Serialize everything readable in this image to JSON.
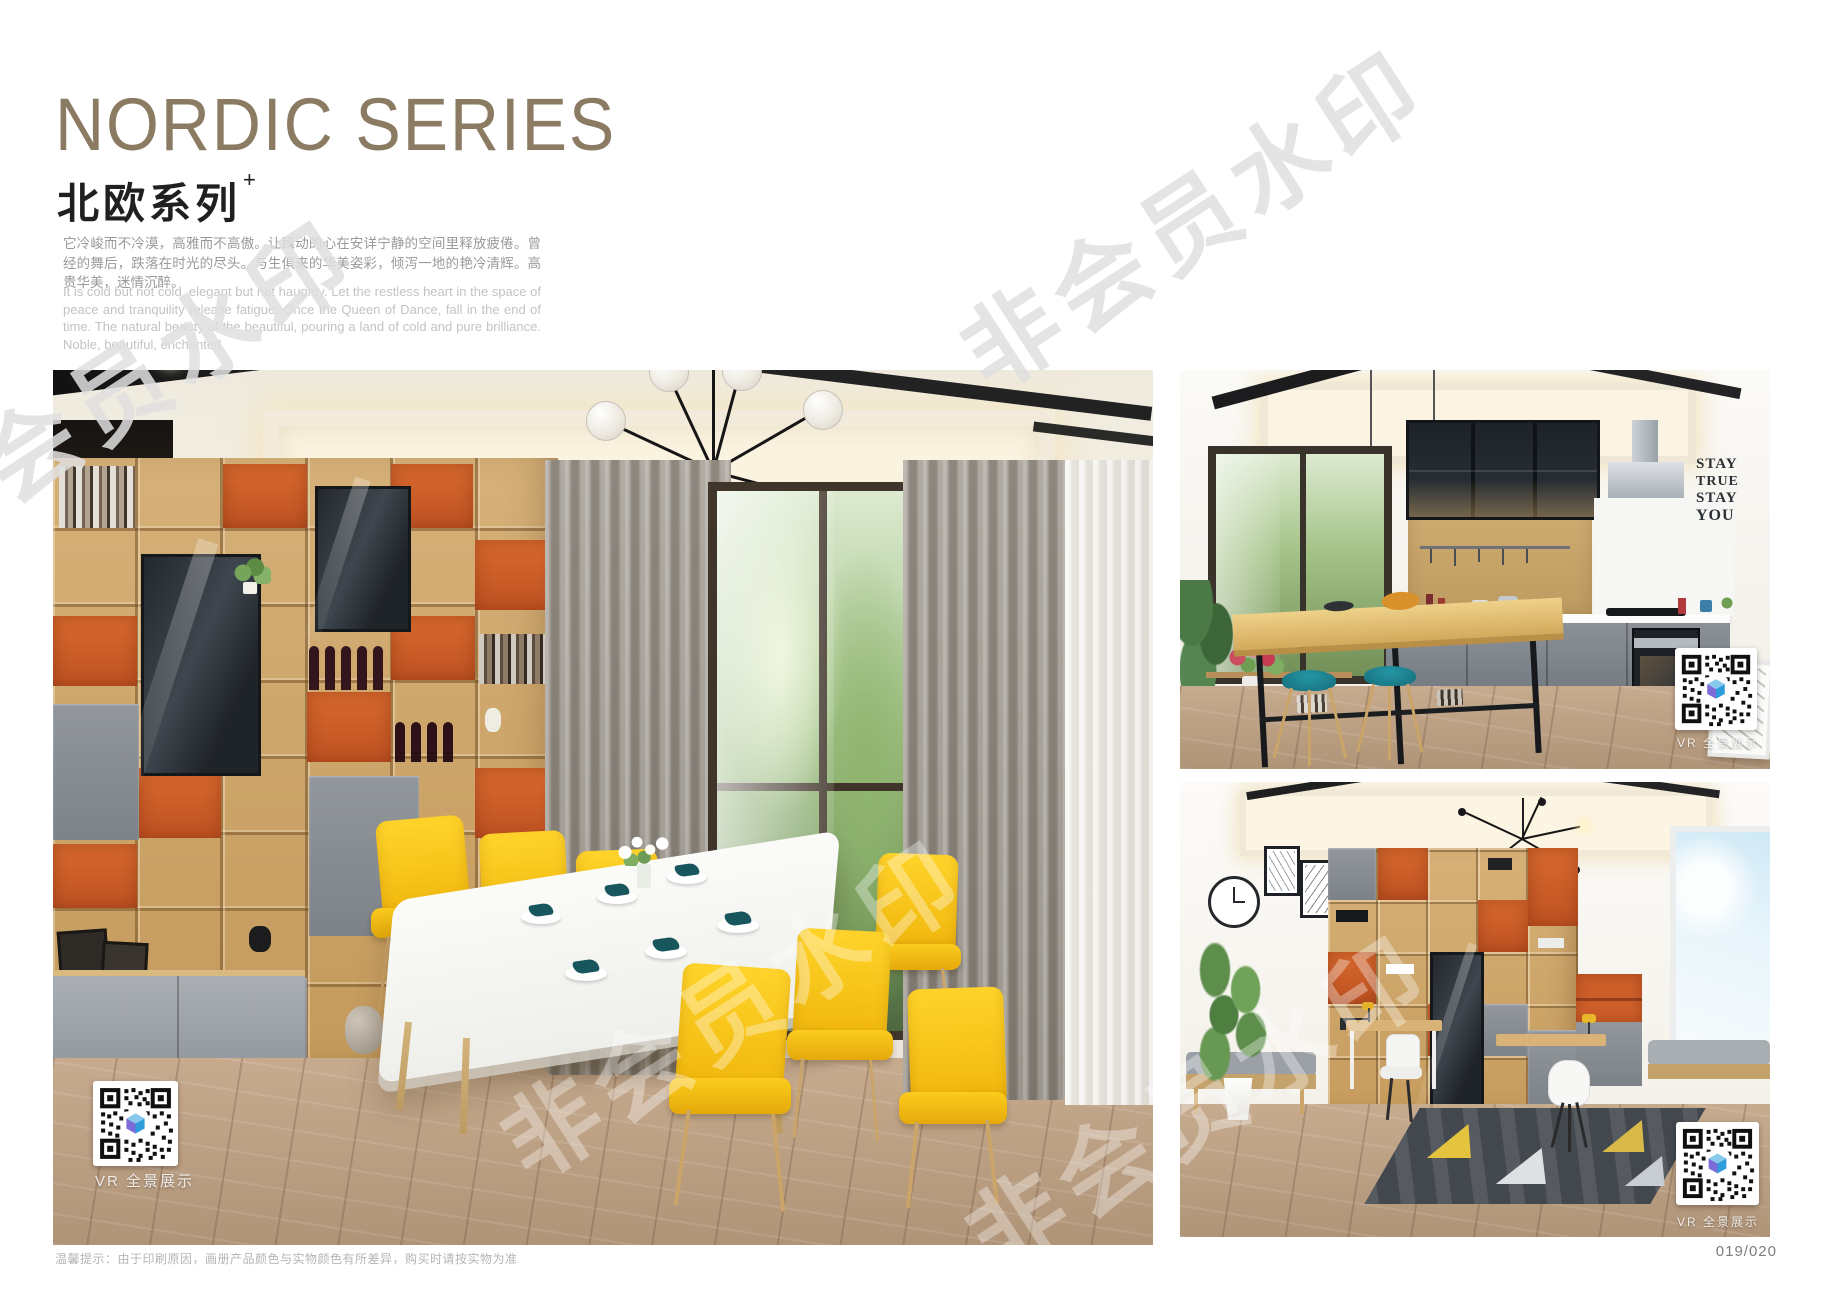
{
  "header": {
    "title": "NORDIC SERIES",
    "subtitle": "北欧系列",
    "subtitle_sup": "+",
    "desc_cn": "它冷峻而不冷漠，高雅而不高傲。让躁动的心在安详宁静的空间里释放疲倦。曾经的舞后，跌落在时光的尽头。与生俱来的华美姿彩，倾泻一地的艳冷清辉。高贵华美，迷情沉醉。",
    "desc_en": "It is cold but not cold, elegant but not haughty. Let the restless heart in the space of peace and tranquility release fatigue. Once the Queen of Dance, fall in the end of time. The natural beauty of the beautiful, pouring a land of cold and pure brilliance. Noble, beautiful, enchanted."
  },
  "watermark": {
    "text": "非会员水印"
  },
  "photos": {
    "vr_label": "VR 全景展示",
    "kitchen_wall_art": [
      "STAY",
      "TRUE",
      "STAY",
      "YOU"
    ]
  },
  "footer": {
    "note": "温馨提示：由于印刷原因，画册产品颜色与实物颜色有所差异，购买时请按实物为准",
    "page_number": "019/020"
  },
  "colors": {
    "title_accent": "#8c7b63",
    "chair_yellow": "#f5c21d",
    "stool_teal": "#1b7d8a",
    "shelf_orange": "#cd5d28",
    "cabinet_gray": "#868c92"
  }
}
